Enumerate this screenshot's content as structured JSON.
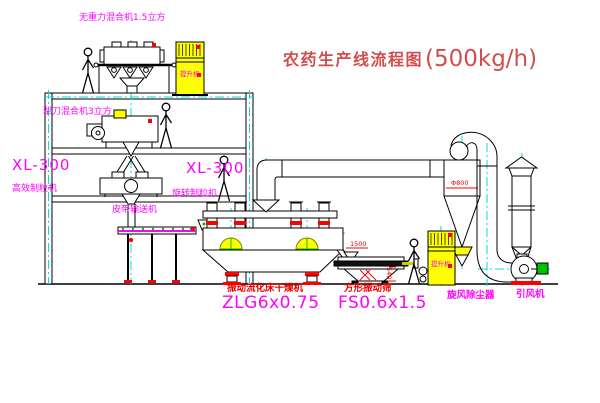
{
  "title": {
    "name": "农药生产线流程图",
    "capacity": "(500kg/h)"
  },
  "colors": {
    "title_red": "#d24d4d",
    "label_magenta": "#ff00ff",
    "label_red": "#e80000",
    "centerline_cyan": "#00dcdc",
    "machine_yellow": "#ffff00",
    "motor_green": "#00c000"
  },
  "equipment_labels": {
    "gravity_mixer": "无重力混合机1.5立方",
    "plow_mixer": "犁刀混合机3立方",
    "granulator_left_model": "XL-300",
    "granulator_left_name": "高效制粒机",
    "granulator_right_model": "XL-300",
    "granulator_right_name": "旋转制粒机",
    "belt_conveyor": "皮带输送机",
    "dryer_name": "振动流化床干燥机",
    "dryer_model": "ZLG6x0.75",
    "sieve_name": "方形振动筛",
    "sieve_model": "FS0.6x1.5",
    "cyclone": "旋风除尘器",
    "fan": "引风机",
    "elevator1": "提升机",
    "elevator2": "提升机"
  },
  "dimensions": {
    "sieve_length": "1500",
    "sieve_height": "540",
    "cyclone_diameter": "Φ800"
  }
}
